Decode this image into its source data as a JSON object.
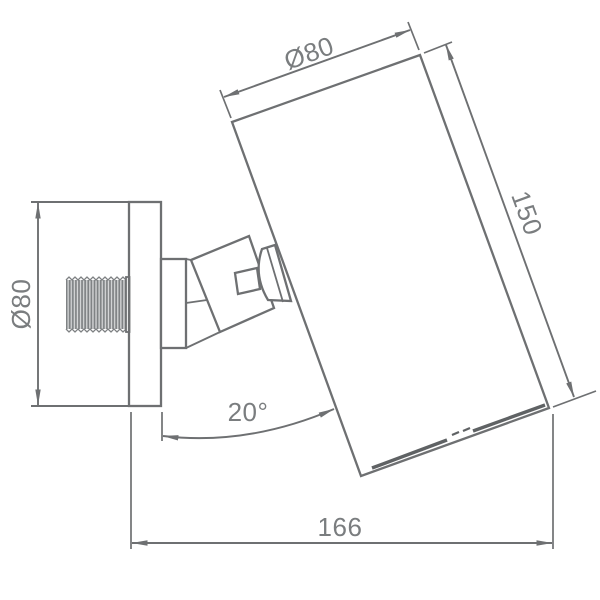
{
  "drawing": {
    "type": "technical-dimension-drawing",
    "subject": "adjustable wall spotlight side view",
    "colors": {
      "line": "#6e7072",
      "text": "#7a7d7f",
      "background": "#ffffff"
    },
    "labels": {
      "flange_diameter": "Ø80",
      "head_diameter": "Ø80",
      "head_length": "150",
      "tilt_angle": "20°",
      "overall_projection": "166"
    }
  }
}
